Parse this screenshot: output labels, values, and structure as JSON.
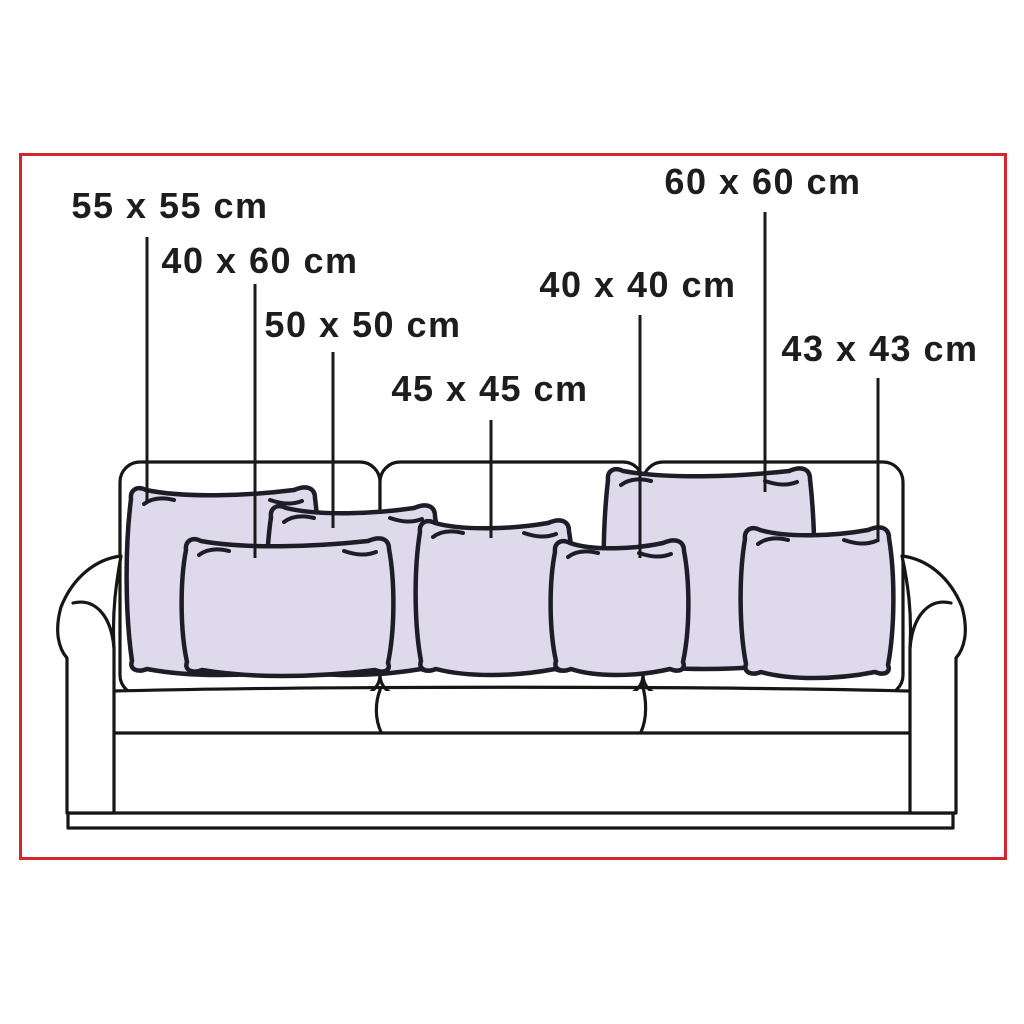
{
  "labels": [
    {
      "text": "55 x 55 cm",
      "sizes_cm": [
        55,
        55
      ]
    },
    {
      "text": "40 x 60 cm",
      "sizes_cm": [
        40,
        60
      ]
    },
    {
      "text": "50 x 50 cm",
      "sizes_cm": [
        50,
        50
      ]
    },
    {
      "text": "45 x 45 cm",
      "sizes_cm": [
        45,
        45
      ]
    },
    {
      "text": "40 x 40 cm",
      "sizes_cm": [
        40,
        40
      ]
    },
    {
      "text": "60 x 60 cm",
      "sizes_cm": [
        60,
        60
      ]
    },
    {
      "text": "43 x 43 cm",
      "sizes_cm": [
        43,
        43
      ]
    }
  ],
  "colors": {
    "frame_red": "#d4262c",
    "pillow_fill": "#dedaec",
    "pillow_outline": "#1d1d28",
    "sofa_outline": "#161616",
    "label_text": "#1d1d1d",
    "background": "#ffffff"
  }
}
